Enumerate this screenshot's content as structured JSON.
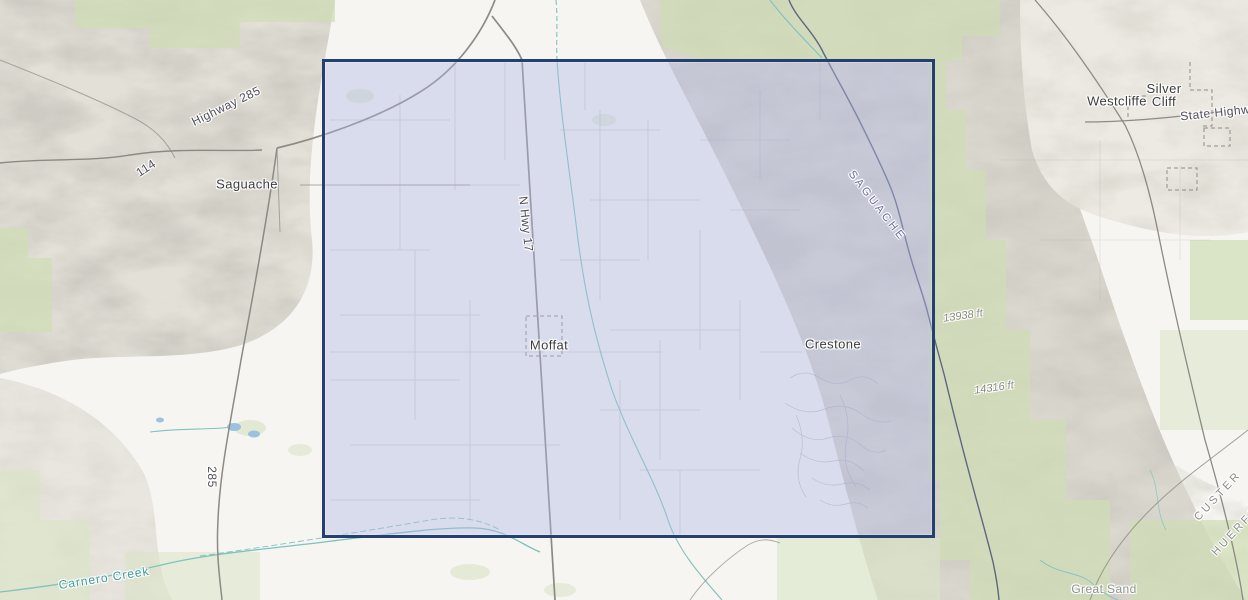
{
  "map": {
    "type": "topographic-basemap-with-selection-extent",
    "selection_extent": {
      "x": 322,
      "y": 59,
      "width": 607,
      "height": 473
    },
    "labels": {
      "towns": [
        {
          "id": "saguache",
          "text": "Saguache"
        },
        {
          "id": "moffat",
          "text": "Moffat"
        },
        {
          "id": "crestone",
          "text": "Crestone"
        },
        {
          "id": "westcliffe",
          "text": "Westcliffe"
        },
        {
          "id": "silver-cliff",
          "line1": "Silver",
          "line2": "Cliff"
        }
      ],
      "roads": [
        {
          "id": "highway-285",
          "text": "Highway 285"
        },
        {
          "id": "route-114",
          "text": "114"
        },
        {
          "id": "n-hwy-17",
          "text": "N Hwy 17"
        },
        {
          "id": "route-285",
          "text": "285"
        },
        {
          "id": "state-highway",
          "text": "State Highway"
        }
      ],
      "counties": [
        {
          "id": "saguache-county",
          "text": "SAGUACHE"
        },
        {
          "id": "custer-county",
          "text": "CUSTER"
        },
        {
          "id": "huerfano-county",
          "text": "HUERFANO"
        }
      ],
      "elevations": [
        {
          "id": "peak-13938",
          "text": "13938 ft"
        },
        {
          "id": "peak-14316",
          "text": "14316 ft"
        }
      ],
      "water": [
        {
          "id": "carnero-creek",
          "text": "Carnero Creek"
        }
      ],
      "places": [
        {
          "id": "great-sand",
          "text": "Great Sand"
        }
      ]
    },
    "colors": {
      "background": "#f6f5f1",
      "hillshade_gray": "#9e9a8f",
      "forest_green": "#dfe8d0",
      "road_gray": "#8d8984",
      "water_teal": "#7fc2bf",
      "county_boundary": "#4f5b78",
      "selection_fill": "rgba(176,183,231,0.40)",
      "selection_border": "#24406e",
      "town_label": "#3d3d3d",
      "county_label_blue": "#6f6f9f",
      "county_label_gray": "#8c8c8c",
      "water_label": "#3f9d9a",
      "elevation_label": "#8d8b80"
    }
  }
}
